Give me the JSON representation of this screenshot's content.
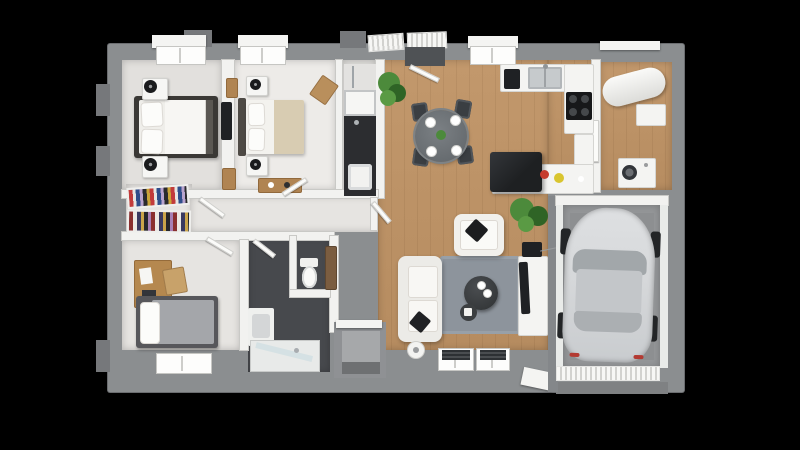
{
  "scene": {
    "description": "3D rendered top-down floor plan of a single-storey house with attached garage, no text labels",
    "background": "#000000"
  },
  "colors": {
    "bg": "#000000",
    "wall": "#8b8e90",
    "wall-dark": "#76787b",
    "white-wall": "#f2f2f0",
    "wood": "#c2986c",
    "wood-dark": "#b68c60",
    "wood-furn": "#b08452",
    "dark-bath": "#47494d",
    "dark-counter": "#2c2d30",
    "garage-floor": "#949698",
    "rug": "#8d949c",
    "black-item": "#1f2124",
    "chair": "#3a3e42",
    "green": "#4c8a3b",
    "green-dark": "#2f6426",
    "car-body": "#d6d8da",
    "car-glass": "#a2a7aa",
    "beige": "#d8ccb2",
    "red-accent": "#c63c2e",
    "yellow-accent": "#d9c52f"
  },
  "rooms": [
    {
      "name": "bedroom-1",
      "furniture": [
        "double-bed",
        "nightstand",
        "nightstand",
        "black-table-lamp",
        "black-table-lamp",
        "wall-tv",
        "dresser"
      ]
    },
    {
      "name": "bedroom-2",
      "furniture": [
        "double-bed",
        "nightstand",
        "nightstand",
        "black-table-lamp",
        "black-table-lamp",
        "wooden-sideboard",
        "wooden-chair"
      ]
    },
    {
      "name": "shower-room",
      "furniture": [
        "shower",
        "dark-vanity-counter",
        "washbasin"
      ]
    },
    {
      "name": "hallway",
      "furniture": [
        "white-doors"
      ]
    },
    {
      "name": "dressing",
      "furniture": [
        "shelving-unit-with-clothes",
        "shelving-unit-with-clothes"
      ]
    },
    {
      "name": "living-dining-room",
      "furniture": [
        "white-sofa",
        "white-armchair",
        "gray-rug",
        "round-coffee-table",
        "tv-stand",
        "tv",
        "speaker",
        "dining-table",
        "four-dining-chairs",
        "potted-plant",
        "potted-plant",
        "side-table"
      ]
    },
    {
      "name": "kitchen",
      "furniture": [
        "counter-with-sink",
        "coffee-machine",
        "cooktop",
        "bar-counter",
        "dark-cabinet",
        "fruit-bowl"
      ]
    },
    {
      "name": "utility-room",
      "furniture": [
        "water-heater",
        "wall-cabinet",
        "washing-machine"
      ]
    },
    {
      "name": "bedroom-3",
      "furniture": [
        "single-bed",
        "desk",
        "wooden-chair"
      ]
    },
    {
      "name": "bathroom-wc",
      "furniture": [
        "toilet",
        "washbasin-cabinet",
        "walk-in-shower"
      ]
    },
    {
      "name": "garage",
      "furniture": [
        "car"
      ]
    },
    {
      "name": "entrance",
      "furniture": [
        "front-door",
        "outdoor-steps"
      ]
    }
  ]
}
